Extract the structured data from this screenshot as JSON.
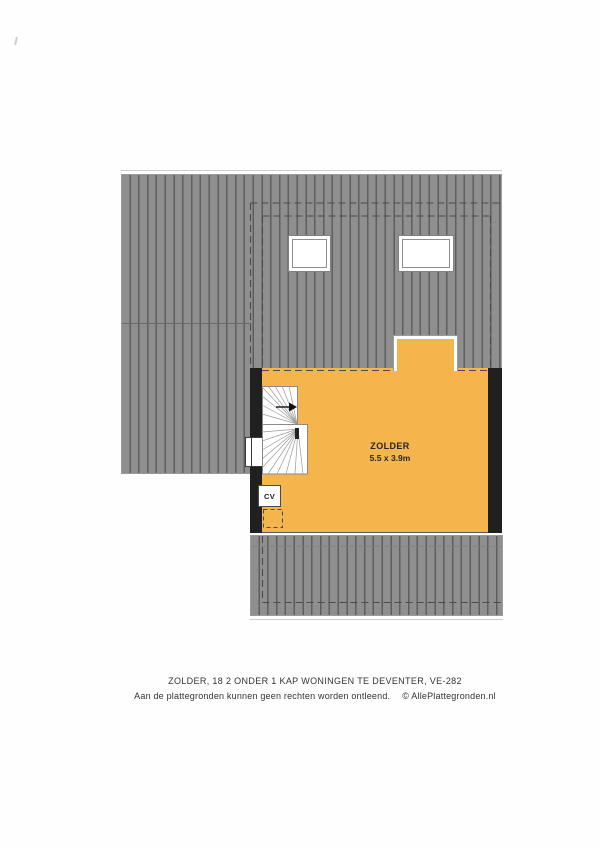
{
  "plan": {
    "room": {
      "name": "ZOLDER",
      "dimensions": "5.5 x 3.9m"
    },
    "cv_label": "CV",
    "colors": {
      "roof_gray": "#8f8f8f",
      "roof_stripe": "#5e5e5e",
      "room_orange": "#f4b54d",
      "wall_black": "#20211f",
      "dash_line": "#4a4a4a"
    }
  },
  "footer": {
    "title": "ZOLDER, 18 2 ONDER 1 KAP WONINGEN TE DEVENTER, VE-282",
    "disclaimer": "Aan de plattegronden kunnen geen rechten worden ontleend.",
    "copyright": "©  AllePlattegronden.nl"
  }
}
